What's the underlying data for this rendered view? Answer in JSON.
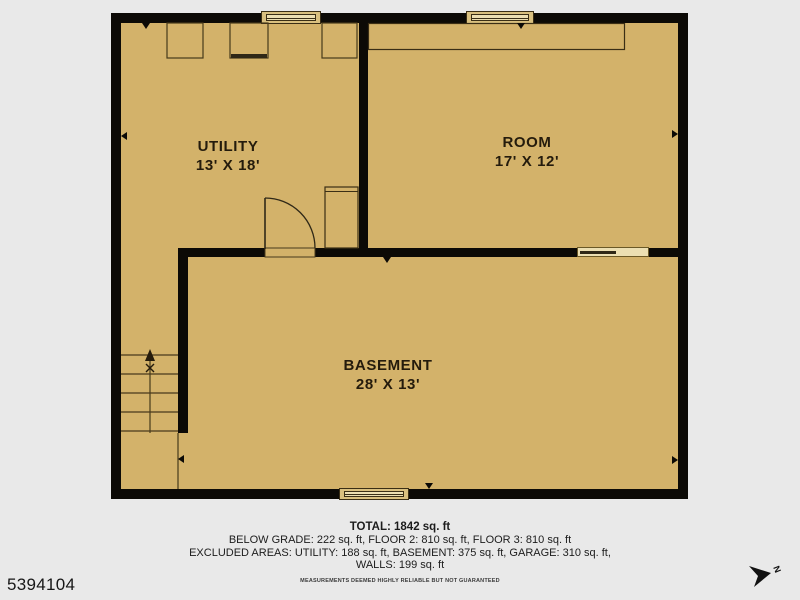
{
  "listing_id": "5394104",
  "compass": {
    "label": "N"
  },
  "rooms": [
    {
      "name": "UTILITY",
      "dimensions": "13' X 18'"
    },
    {
      "name": "ROOM",
      "dimensions": "17' X 12'"
    },
    {
      "name": "BASEMENT",
      "dimensions": "28' X 13'"
    }
  ],
  "footer": {
    "total": "TOTAL: 1842 sq. ft",
    "below_grade": "BELOW GRADE: 222 sq. ft, FLOOR 2: 810 sq. ft, FLOOR 3: 810 sq. ft",
    "excluded": "EXCLUDED AREAS: UTILITY: 188 sq. ft, BASEMENT: 375 sq. ft, GARAGE: 310 sq. ft,",
    "walls": "WALLS: 199 sq. ft",
    "disclaimer": "MEASUREMENTS DEEMED HIGHLY RELIABLE BUT NOT GUARANTEED"
  },
  "colors": {
    "background": "#e9e9e9",
    "floor": "#d3b26a",
    "wall": "#0c0a06",
    "linework": "#473a1c",
    "window_fill": "#ecdfb2",
    "label_text": "#241b0c"
  }
}
